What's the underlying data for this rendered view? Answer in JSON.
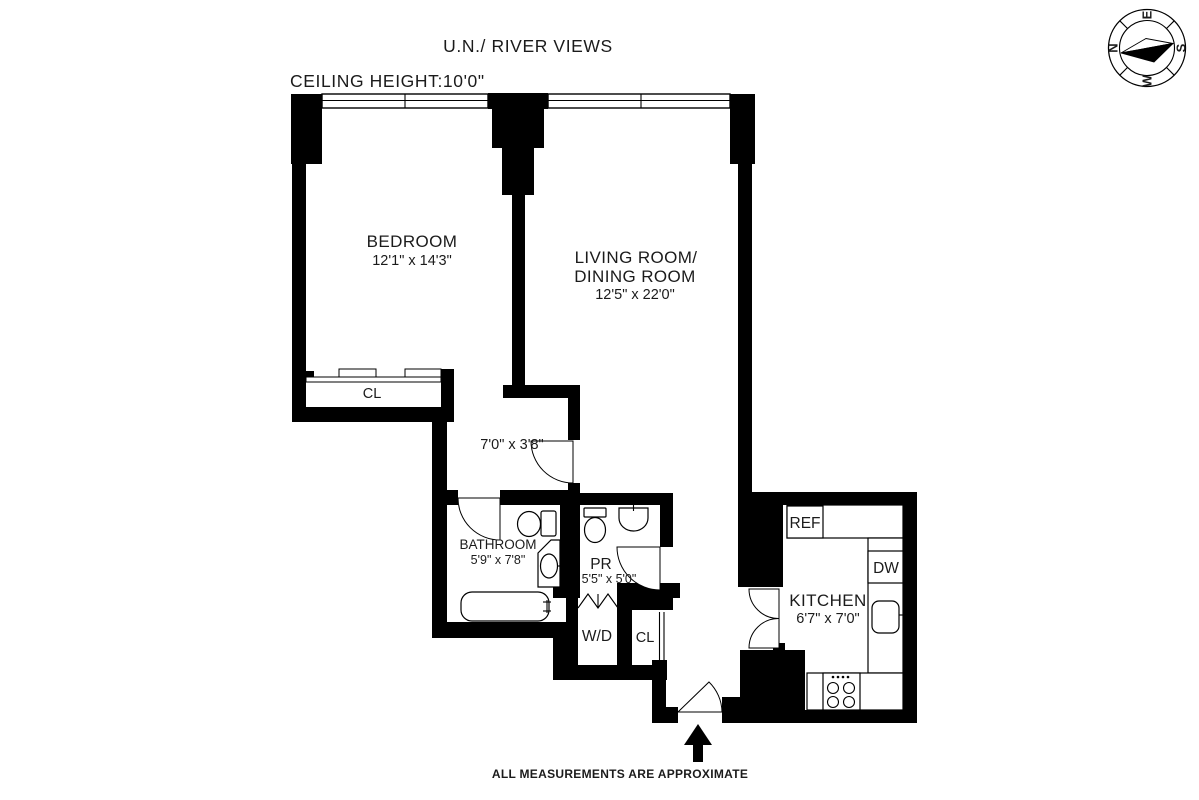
{
  "page": {
    "background_color": "#ffffff",
    "ink_color": "#000000",
    "views_title": "U.N./ RIVER VIEWS",
    "ceiling_height": "CEILING HEIGHT:10'0\"",
    "disclaimer": "ALL MEASUREMENTS ARE APPROXIMATE"
  },
  "compass": {
    "n": "N",
    "e": "E",
    "s": "S",
    "w": "W"
  },
  "rooms": {
    "bedroom": {
      "name": "BEDROOM",
      "dims": "12'1\" x 14'3\""
    },
    "living": {
      "name_line1": "LIVING ROOM/",
      "name_line2": "DINING ROOM",
      "dims": "12'5\" x 22'0\""
    },
    "hallway": {
      "dims": "7'0\" x 3'8\""
    },
    "bathroom": {
      "name": "BATHROOM",
      "dims": "5'9\" x 7'8\""
    },
    "powder_room": {
      "name": "PR",
      "dims": "5'5\" x 5'0\""
    },
    "washer_dryer": {
      "name": "W/D"
    },
    "bedroom_closet": {
      "name": "CL"
    },
    "entry_closet": {
      "name": "CL"
    },
    "kitchen": {
      "name": "KITCHEN",
      "dims": "6'7\" x 7'0\"",
      "refrigerator": "REF",
      "dishwasher": "DW"
    }
  }
}
